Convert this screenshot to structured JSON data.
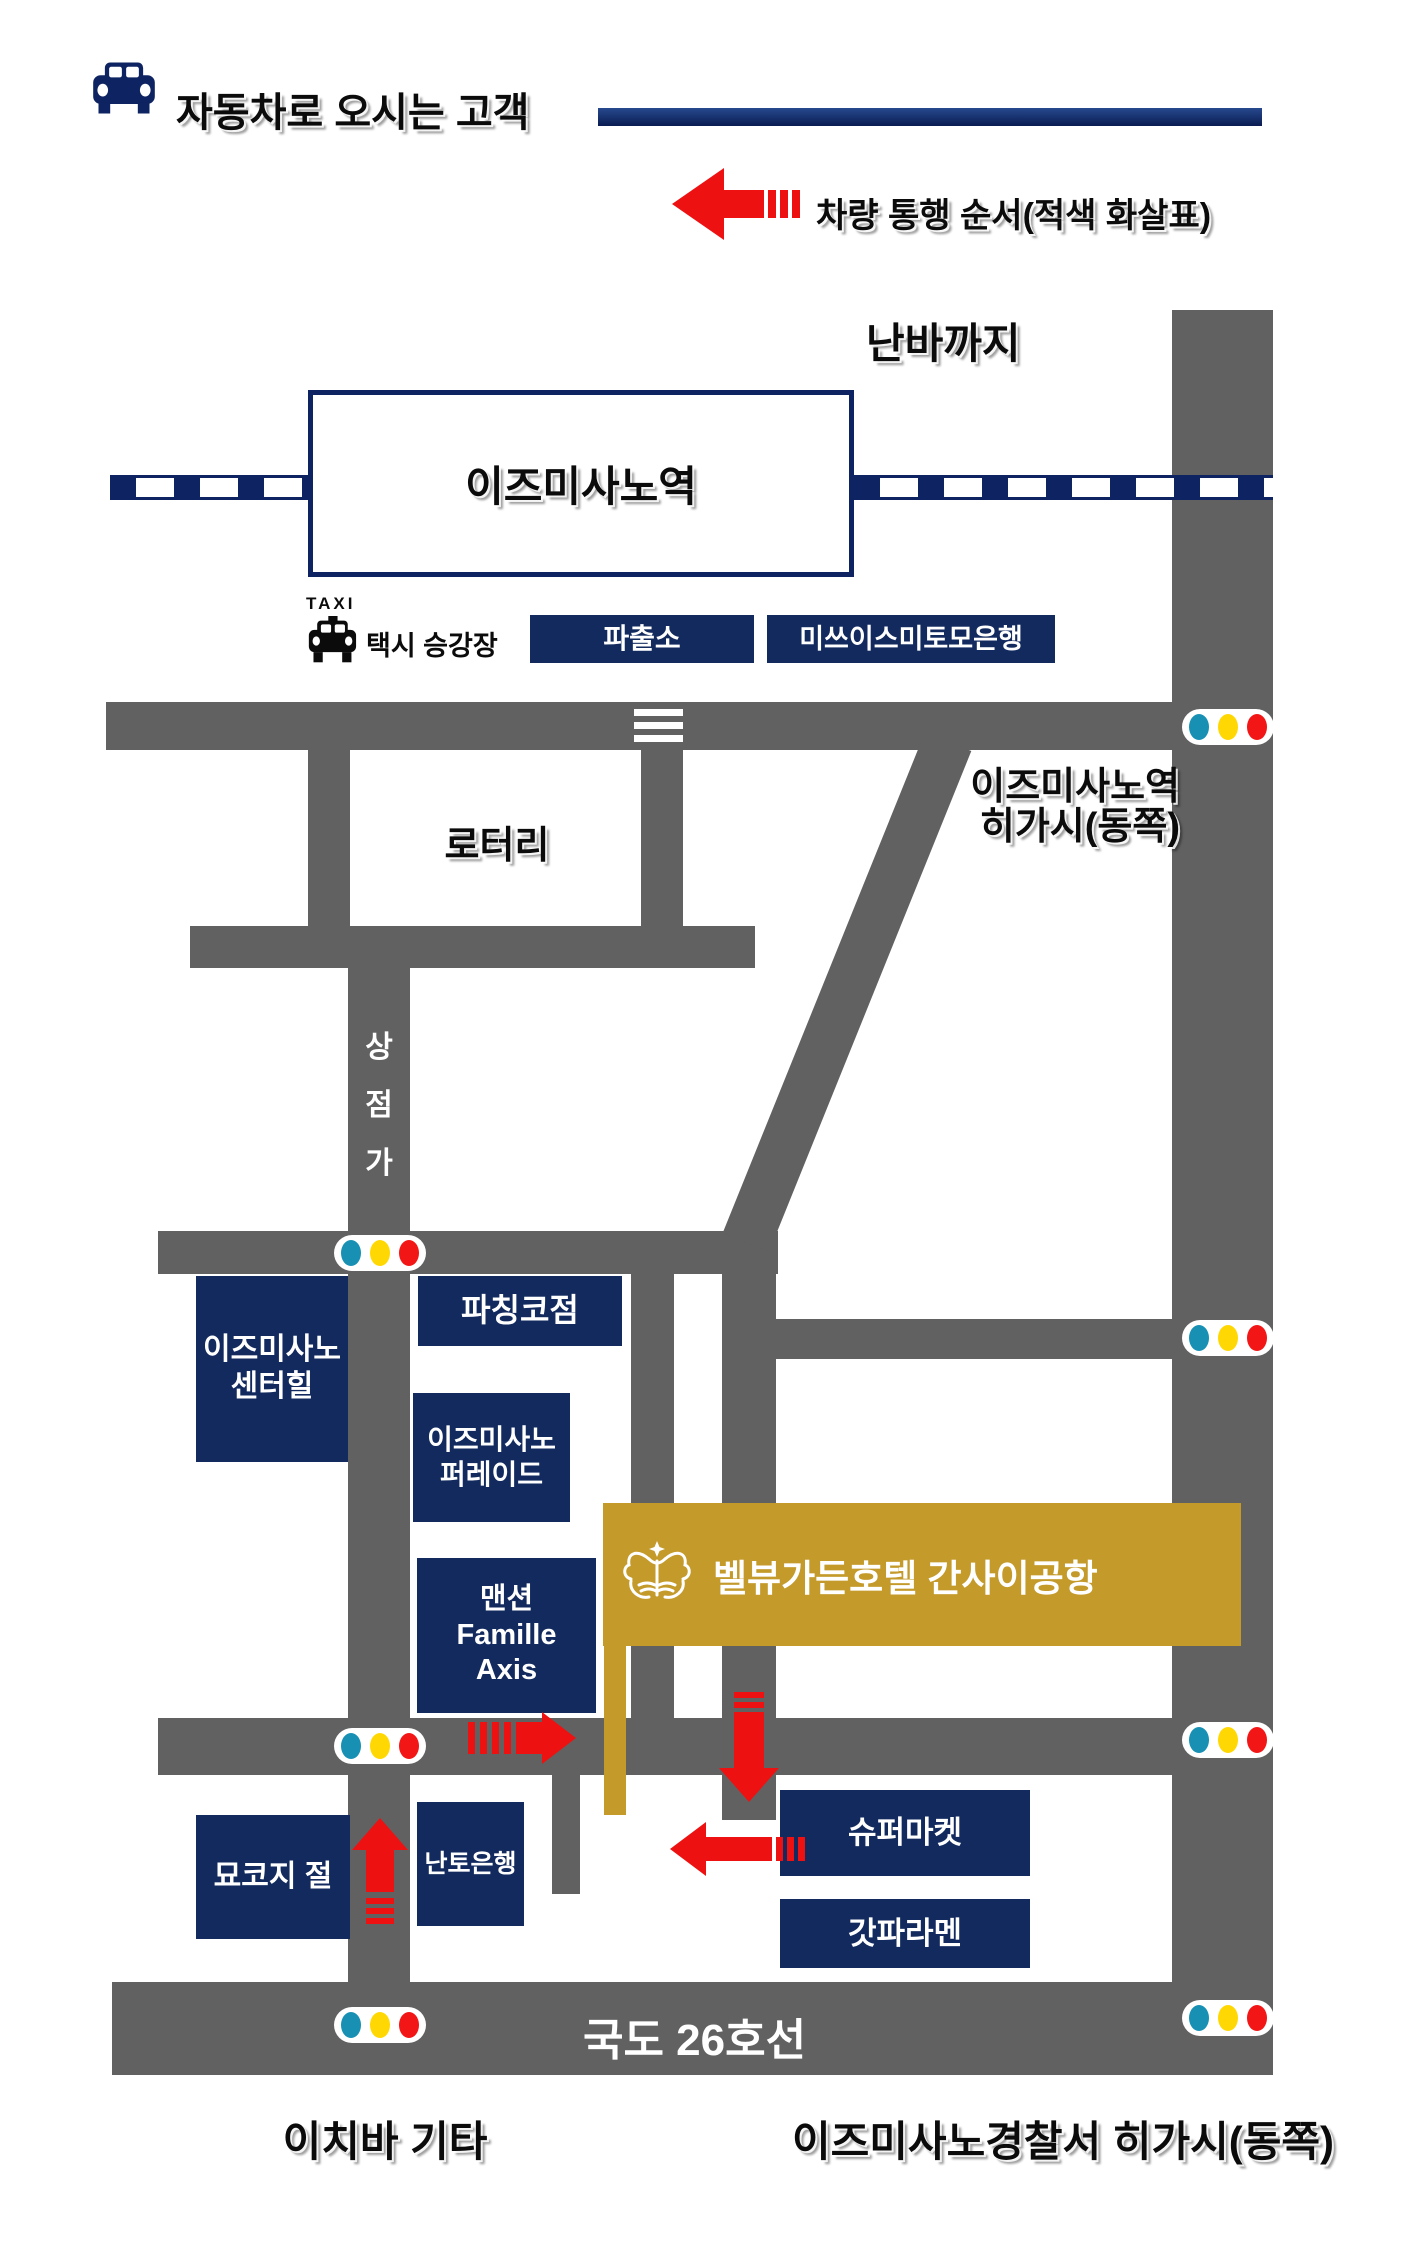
{
  "header": {
    "title": "자동차로 오시는 고객"
  },
  "legend": {
    "label": "차량 통행 순서(적색 화살표)"
  },
  "labels": {
    "namba": "난바까지",
    "station": "이즈미사노역",
    "taxi_small": "TAXI",
    "taxi_stand": "택시 승강장",
    "rotary": "로터리",
    "station_east_line1": "이즈미사노역",
    "station_east_line2": "히가시(동쪽)",
    "shopping_street": [
      "상",
      "점",
      "가"
    ],
    "route26": "국도 26호선",
    "ichiba_kita": "이치바 기타",
    "police_east": "이즈미사노경찰서 히가시(동쪽)"
  },
  "buildings": {
    "police_box": "파출소",
    "bank_smbc": "미쓰이스미토모은행",
    "center_hill": [
      "이즈미사노",
      "센터힐"
    ],
    "pachinko": "파칭코점",
    "parade": [
      "이즈미사노",
      "퍼레이드"
    ],
    "famille": [
      "맨션",
      "Famille",
      "Axis"
    ],
    "myokoji": "묘코지 절",
    "nanto_bank": "난토은행",
    "supermarket": "슈퍼마켓",
    "ramen": "갓파라멘"
  },
  "hotel": {
    "name": "벨뷰가든호텔 간사이공항"
  },
  "colors": {
    "navy": "#0e2361",
    "building_navy": "#122a5e",
    "road_gray": "#616161",
    "hotel_gold": "#c49a2b",
    "arrow_red": "#ee1111",
    "signal_teal": "#1790b4",
    "signal_yellow": "#ffd803",
    "signal_red": "#f31616"
  }
}
